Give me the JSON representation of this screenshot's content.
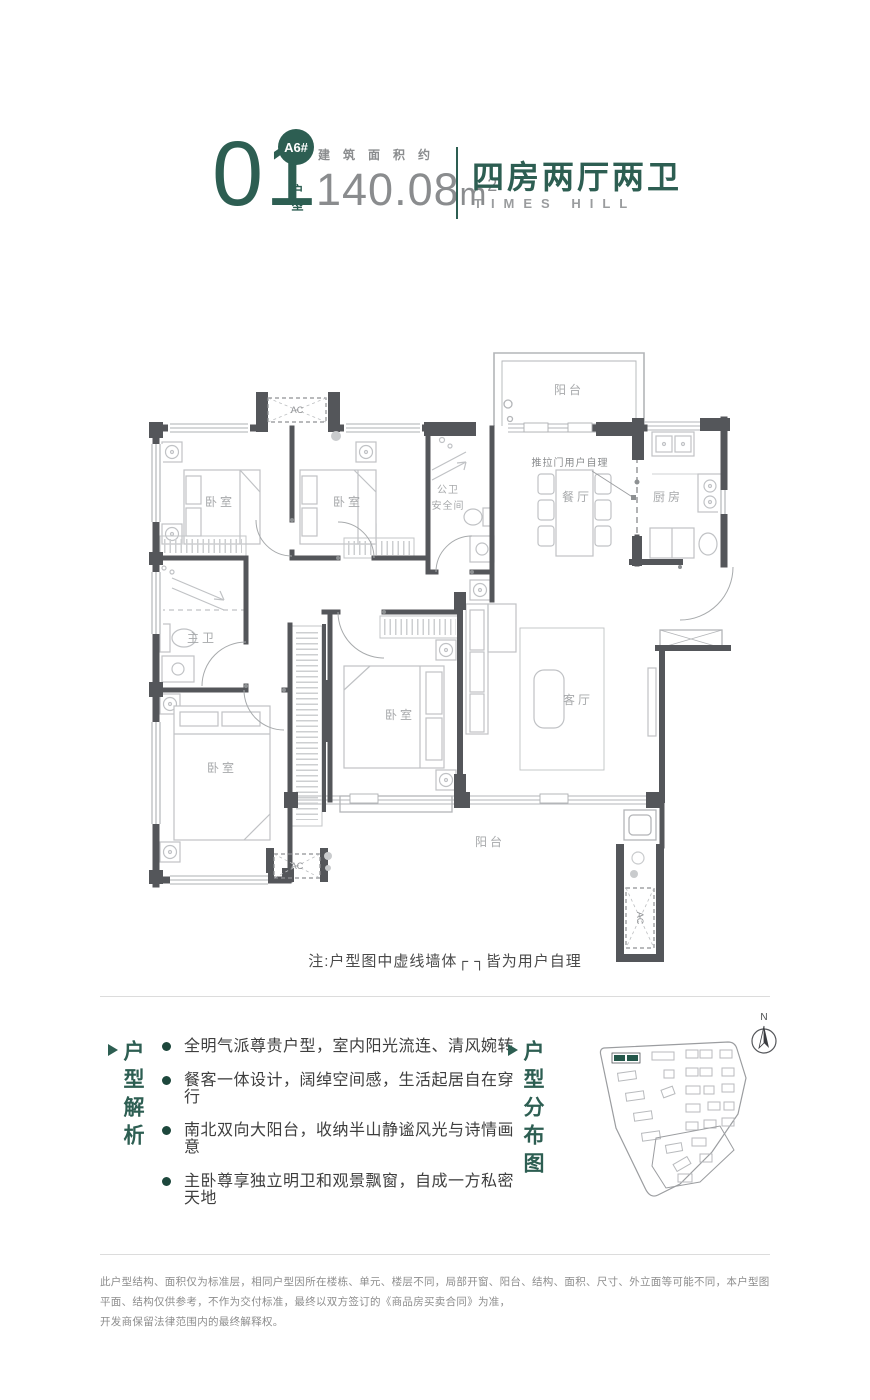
{
  "colors": {
    "accent": "#2d5e52",
    "accent_dark": "#1d473c",
    "wall_gray": "#54565a",
    "line_gray": "#bfc1c4",
    "label_gray": "#a7a9ab"
  },
  "header": {
    "unit_no": "01",
    "unit_label": "户型",
    "badge": "A6#",
    "area_label": "建筑面积约",
    "area_value": "140.08",
    "area_unit": "m",
    "area_sup": "2",
    "type_cn": "四房两厅两卫",
    "type_en": "TIMES HILL"
  },
  "floorplan": {
    "rooms": {
      "balcony_top": "阳台",
      "bedroom_a": "卧室",
      "bedroom_b": "卧室",
      "bath_public_line1": "公卫",
      "bath_public_line2": "安全间",
      "dining": "餐厅",
      "kitchen": "厨房",
      "master_bath": "主卫",
      "bedroom_c": "卧室",
      "bedroom_d": "卧室",
      "living": "客厅",
      "balcony_bottom": "阳台"
    },
    "ac_label": "AC",
    "sliding_door_note": "推拉门用户自理",
    "note": "注:户型图中虚线墙体┌ ┐皆为用户自理"
  },
  "analysis": {
    "title": "户型解析",
    "bullets": [
      "全明气派尊贵户型，室内阳光流连、清风婉转",
      "餐客一体设计，阔绰空间感，生活起居自在穿行",
      "南北双向大阳台，收纳半山静谧风光与诗情画意",
      "主卧尊享独立明卫和观景飘窗，自成一方私密天地"
    ]
  },
  "distribution": {
    "title": "户型分布图",
    "compass": "N"
  },
  "footer": {
    "line1": "此户型结构、面积仅为标准层，相同户型因所在楼栋、单元、楼层不同，局部开窗、阳台、结构、面积、尺寸、外立面等可能不同，本户型图平面、结构仅供参考，不作为交付标准，最终以双方签订的《商品房买卖合同》为准，",
    "line2": "开发商保留法律范围内的最终解释权。"
  }
}
